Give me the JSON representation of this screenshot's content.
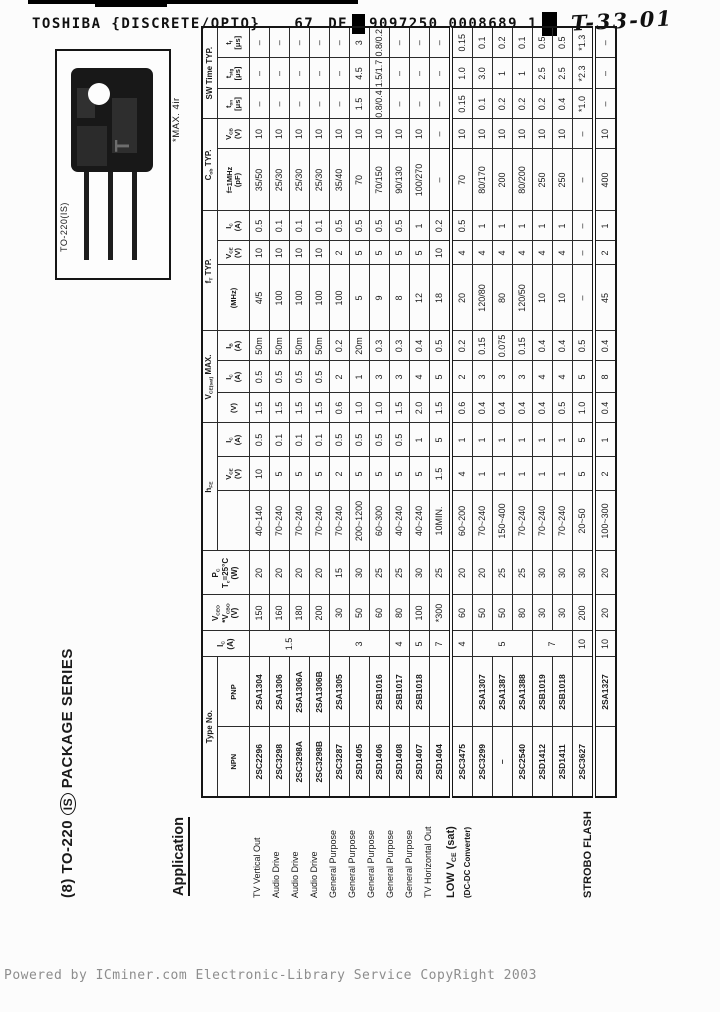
{
  "scan_header": {
    "title": "TOSHIBA {DISCRETE/OPTO}",
    "sheet": "67",
    "de": "DE",
    "barcode": "9097250 0008689 1",
    "handwritten": "T-33-01"
  },
  "page": {
    "title_left": "(8) TO-220",
    "title_circled": "IS",
    "title_right": "PACKAGE SERIES",
    "application_heading": "Application",
    "package_label": "TO-220(IS)",
    "package_note": "*MAX. 4ir"
  },
  "footer": {
    "text": "Powered by ICminer.com Electronic-Library Service CopyRight 2003"
  },
  "table": {
    "headers": {
      "type_no": "Type No.",
      "npn": "NPN",
      "pnp": "PNP",
      "ic": "I_C_\n(A)",
      "vceo": "V_CEO_\n*V_CBO_\n(V)",
      "pc": "P_C_\nT_c_=25°C\n(W)",
      "hfe": "h_FE_",
      "hfe_sub1": "",
      "hfe_vce": "V_CE_\n(V)",
      "hfe_ic": "I_C_\n(A)",
      "vcesat": "V_CE(sat)_ MAX.",
      "vcesat_v": "(V)",
      "vcesat_ic": "I_C_\n(A)",
      "vcesat_ib": "I_B_\n(A)",
      "ft": "f_T_ TYP.",
      "ft_mhz": "(MHz)",
      "ft_vce": "V_CE_\n(V)",
      "ft_ic": "I_C_\n(A)",
      "cob": "C_ob_ TYP.",
      "cob_pf": "f=1MHz\n(pF)",
      "cob_vcb": "V_CB_\n(V)",
      "sw": "SW Time TYP.",
      "sw_ton": "t_on_\n[μs]",
      "sw_tstg": "t_stg_\n[μs]",
      "sw_tf": "t_f_\n[μs]"
    },
    "rows": [
      {
        "app": "TV Vertical Out",
        "npn": "2SC2296",
        "pnp": "2SA1304",
        "ic": "1.5",
        "ic_rowspan": 4,
        "vceo": "150",
        "pc": "20",
        "hfe": "40~140",
        "hfe_vce": "10",
        "hfe_ic": "0.5",
        "vcesat": "1.5",
        "sat_ic": "0.5",
        "sat_ib": "50m",
        "ft": "4/5",
        "ft_vce": "10",
        "ft_ic": "0.5",
        "cob": "35/50",
        "vcb": "10",
        "ton": "–",
        "tstg": "–",
        "tf": "–"
      },
      {
        "app": "Audio Drive",
        "npn": "2SC3298",
        "pnp": "2SA1306",
        "vceo": "160",
        "pc": "20",
        "hfe": "70~240",
        "hfe_vce": "5",
        "hfe_ic": "0.1",
        "vcesat": "1.5",
        "sat_ic": "0.5",
        "sat_ib": "50m",
        "ft": "100",
        "ft_vce": "10",
        "ft_ic": "0.1",
        "cob": "25/30",
        "vcb": "10",
        "ton": "–",
        "tstg": "–",
        "tf": "–"
      },
      {
        "app": "Audio Drive",
        "npn": "2SC3298A",
        "pnp": "2SA1306A",
        "vceo": "180",
        "pc": "20",
        "hfe": "70~240",
        "hfe_vce": "5",
        "hfe_ic": "0.1",
        "vcesat": "1.5",
        "sat_ic": "0.5",
        "sat_ib": "50m",
        "ft": "100",
        "ft_vce": "10",
        "ft_ic": "0.1",
        "cob": "25/30",
        "vcb": "10",
        "ton": "–",
        "tstg": "–",
        "tf": "–"
      },
      {
        "app": "Audio Drive",
        "npn": "2SC3298B",
        "pnp": "2SA1306B",
        "vceo": "200",
        "pc": "20",
        "hfe": "70~240",
        "hfe_vce": "5",
        "hfe_ic": "0.1",
        "vcesat": "1.5",
        "sat_ic": "0.5",
        "sat_ib": "50m",
        "ft": "100",
        "ft_vce": "10",
        "ft_ic": "0.1",
        "cob": "25/30",
        "vcb": "10",
        "ton": "–",
        "tstg": "–",
        "tf": "–"
      },
      {
        "app": "General Purpose",
        "npn": "2SC3287",
        "pnp": "2SA1305",
        "ic": "3",
        "ic_rowspan": 3,
        "vceo": "30",
        "pc": "15",
        "hfe": "70~240",
        "hfe_vce": "2",
        "hfe_ic": "0.5",
        "vcesat": "0.6",
        "sat_ic": "2",
        "sat_ib": "0.2",
        "ft": "100",
        "ft_vce": "2",
        "ft_ic": "0.5",
        "cob": "35/40",
        "vcb": "10",
        "ton": "–",
        "tstg": "–",
        "tf": "–"
      },
      {
        "app": "General Purpose",
        "npn": "2SD1405",
        "pnp": "",
        "vceo": "50",
        "pc": "30",
        "hfe": "200~1200",
        "hfe_vce": "5",
        "hfe_ic": "0.5",
        "vcesat": "1.0",
        "sat_ic": "1",
        "sat_ib": "20m",
        "ft": "5",
        "ft_vce": "5",
        "ft_ic": "0.5",
        "cob": "70",
        "vcb": "10",
        "ton": "1.5",
        "tstg": "4.5",
        "tf": "3"
      },
      {
        "app": "General Purpose",
        "npn": "2SD1406",
        "pnp": "2SB1016",
        "vceo": "60",
        "pc": "25",
        "hfe": "60~300",
        "hfe_vce": "5",
        "hfe_ic": "0.5",
        "vcesat": "1.0",
        "sat_ic": "3",
        "sat_ib": "0.3",
        "ft": "9",
        "ft_vce": "5",
        "ft_ic": "0.5",
        "cob": "70/150",
        "vcb": "10",
        "ton": "0.8/0.4",
        "tstg": "1.5/1.7",
        "tf": "0.8/0.2"
      },
      {
        "app": "General Purpose",
        "npn": "2SD1408",
        "pnp": "2SB1017",
        "ic": "4",
        "vceo": "80",
        "pc": "25",
        "hfe": "40~240",
        "hfe_vce": "5",
        "hfe_ic": "0.5",
        "vcesat": "1.5",
        "sat_ic": "3",
        "sat_ib": "0.3",
        "ft": "8",
        "ft_vce": "5",
        "ft_ic": "0.5",
        "cob": "90/130",
        "vcb": "10",
        "ton": "–",
        "tstg": "–",
        "tf": "–"
      },
      {
        "app": "General Purpose",
        "npn": "2SD1407",
        "pnp": "2SB1018",
        "ic": "5",
        "vceo": "100",
        "pc": "30",
        "hfe": "40~240",
        "hfe_vce": "5",
        "hfe_ic": "1",
        "vcesat": "2.0",
        "sat_ic": "4",
        "sat_ib": "0.4",
        "ft": "12",
        "ft_vce": "5",
        "ft_ic": "1",
        "cob": "100/270",
        "vcb": "10",
        "ton": "–",
        "tstg": "–",
        "tf": "–"
      },
      {
        "app": "TV Horizontal Out",
        "npn": "2SD1404",
        "pnp": "",
        "ic": "7",
        "vceo": "*300",
        "pc": "25",
        "hfe": "10MIN.",
        "hfe_vce": "1.5",
        "hfe_ic": "5",
        "vcesat": "1.5",
        "sat_ic": "5",
        "sat_ib": "0.5",
        "ft": "18",
        "ft_vce": "10",
        "ft_ic": "0.2",
        "cob": "–",
        "vcb": "–",
        "ton": "–",
        "tstg": "–",
        "tf": "–"
      },
      {
        "app": "LOW V_CE_ (sat)",
        "app2": "(DC-DC Converter)",
        "app_rowspan": 7,
        "app_big": true,
        "sep": true,
        "npn": "2SC3475",
        "pnp": "",
        "ic": "4",
        "vceo": "60",
        "pc": "20",
        "hfe": "60~200",
        "hfe_vce": "4",
        "hfe_ic": "1",
        "vcesat": "0.6",
        "sat_ic": "2",
        "sat_ib": "0.2",
        "ft": "20",
        "ft_vce": "4",
        "ft_ic": "0.5",
        "cob": "70",
        "vcb": "10",
        "ton": "0.15",
        "tstg": "1.0",
        "tf": "0.15"
      },
      {
        "npn": "2SC3299",
        "pnp": "2SA1307",
        "ic": "5",
        "ic_rowspan": 3,
        "vceo": "50",
        "pc": "20",
        "hfe": "70~240",
        "hfe_vce": "1",
        "hfe_ic": "1",
        "vcesat": "0.4",
        "sat_ic": "3",
        "sat_ib": "0.15",
        "ft": "120/80",
        "ft_vce": "4",
        "ft_ic": "1",
        "cob": "80/170",
        "vcb": "10",
        "ton": "0.1",
        "tstg": "3.0",
        "tf": "0.1"
      },
      {
        "npn": "–",
        "pnp": "2SA1387",
        "vceo": "50",
        "pc": "25",
        "hfe": "150~400",
        "hfe_vce": "1",
        "hfe_ic": "1",
        "vcesat": "0.4",
        "sat_ic": "3",
        "sat_ib": "0.075",
        "ft": "80",
        "ft_vce": "4",
        "ft_ic": "1",
        "cob": "200",
        "vcb": "10",
        "ton": "0.2",
        "tstg": "1",
        "tf": "0.2"
      },
      {
        "npn": "2SC2540",
        "pnp": "2SA1388",
        "vceo": "80",
        "pc": "25",
        "hfe": "70~240",
        "hfe_vce": "1",
        "hfe_ic": "1",
        "vcesat": "0.4",
        "sat_ic": "3",
        "sat_ib": "0.15",
        "ft": "120/50",
        "ft_vce": "4",
        "ft_ic": "1",
        "cob": "80/200",
        "vcb": "10",
        "ton": "0.2",
        "tstg": "1",
        "tf": "0.1"
      },
      {
        "npn": "2SD1412",
        "pnp": "2SB1019",
        "ic": "7",
        "ic_rowspan": 2,
        "vceo": "30",
        "pc": "30",
        "hfe": "70~240",
        "hfe_vce": "1",
        "hfe_ic": "1",
        "vcesat": "0.4",
        "sat_ic": "4",
        "sat_ib": "0.4",
        "ft": "10",
        "ft_vce": "4",
        "ft_ic": "1",
        "cob": "250",
        "vcb": "10",
        "ton": "0.2",
        "tstg": "2.5",
        "tf": "0.5"
      },
      {
        "npn": "2SD1411",
        "pnp": "2SB1018",
        "vceo": "30",
        "pc": "30",
        "hfe": "70~240",
        "hfe_vce": "1",
        "hfe_ic": "1",
        "vcesat": "0.5",
        "sat_ic": "4",
        "sat_ib": "0.4",
        "ft": "10",
        "ft_vce": "4",
        "ft_ic": "1",
        "cob": "250",
        "vcb": "10",
        "ton": "0.4",
        "tstg": "2.5",
        "tf": "0.5"
      },
      {
        "npn": "2SC3627",
        "pnp": "",
        "ic": "10",
        "vceo": "200",
        "pc": "30",
        "hfe": "20~50",
        "hfe_vce": "5",
        "hfe_ic": "5",
        "vcesat": "1.0",
        "sat_ic": "5",
        "sat_ib": "0.5",
        "ft": "–",
        "ft_vce": "–",
        "ft_ic": "–",
        "cob": "–",
        "vcb": "–",
        "ton": "*1.0",
        "tstg": "*2.3",
        "tf": "*1.3"
      },
      {
        "app": "STROBO FLASH",
        "app_big": true,
        "sep": true,
        "npn": "",
        "pnp": "2SA1327",
        "ic": "10",
        "vceo": "20",
        "pc": "20",
        "hfe": "100~300",
        "hfe_vce": "2",
        "hfe_ic": "1",
        "vcesat": "0.4",
        "sat_ic": "8",
        "sat_ib": "0.4",
        "ft": "45",
        "ft_vce": "2",
        "ft_ic": "1",
        "cob": "400",
        "vcb": "10",
        "ton": "–",
        "tstg": "–",
        "tf": "–"
      }
    ]
  }
}
